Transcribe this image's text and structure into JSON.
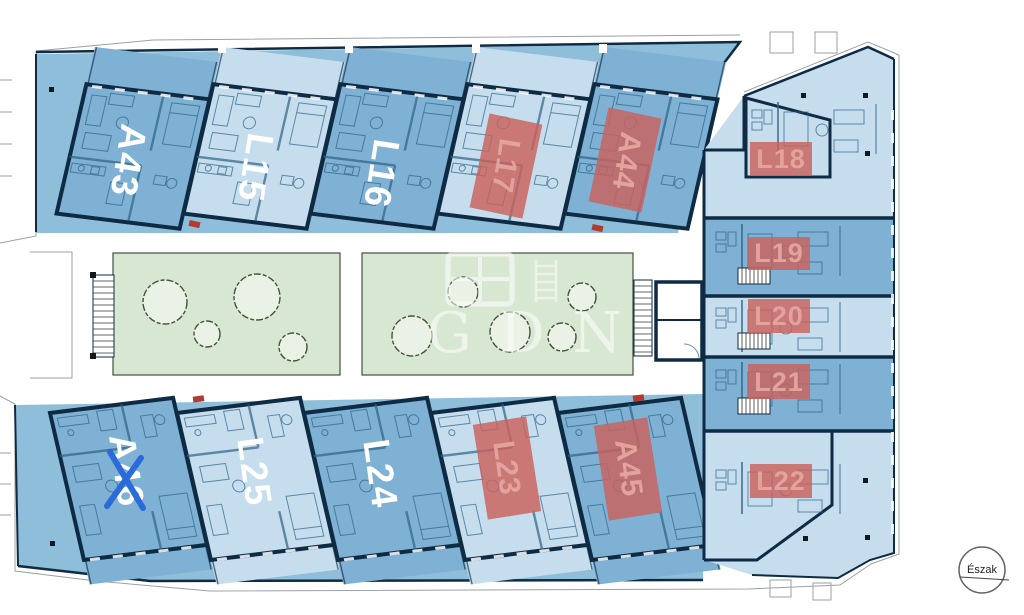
{
  "plan": {
    "compass_label": "Észak",
    "watermark_text": "GDN",
    "wings": {
      "top": [
        {
          "label": "A43",
          "marker": "none"
        },
        {
          "label": "L15",
          "marker": "none"
        },
        {
          "label": "L16",
          "marker": "none"
        },
        {
          "label": "L17",
          "marker": "red-box"
        },
        {
          "label": "A44",
          "marker": "red-box"
        }
      ],
      "right": [
        {
          "label": "L18",
          "marker": "red-box"
        },
        {
          "label": "L19",
          "marker": "red-box"
        },
        {
          "label": "L20",
          "marker": "red-box"
        },
        {
          "label": "L21",
          "marker": "red-box"
        },
        {
          "label": "L22",
          "marker": "red-box"
        }
      ],
      "bottom": [
        {
          "label": "A46",
          "marker": "blue-x"
        },
        {
          "label": "L25",
          "marker": "none"
        },
        {
          "label": "L24",
          "marker": "none"
        },
        {
          "label": "L23",
          "marker": "red-box"
        },
        {
          "label": "A45",
          "marker": "red-box"
        }
      ]
    },
    "colors": {
      "unit_medium": "#7eb1d3",
      "unit_light": "#c6ddee",
      "terrace": "#8fbeda",
      "wall": "#0f2b44",
      "courtyard_green": "#d8e7d2",
      "tree_fill": "#eaf2e6",
      "highlight_red": "#c9625c",
      "highlight_label": "#e2a39c",
      "mark_blue": "#2b6bd9"
    }
  }
}
